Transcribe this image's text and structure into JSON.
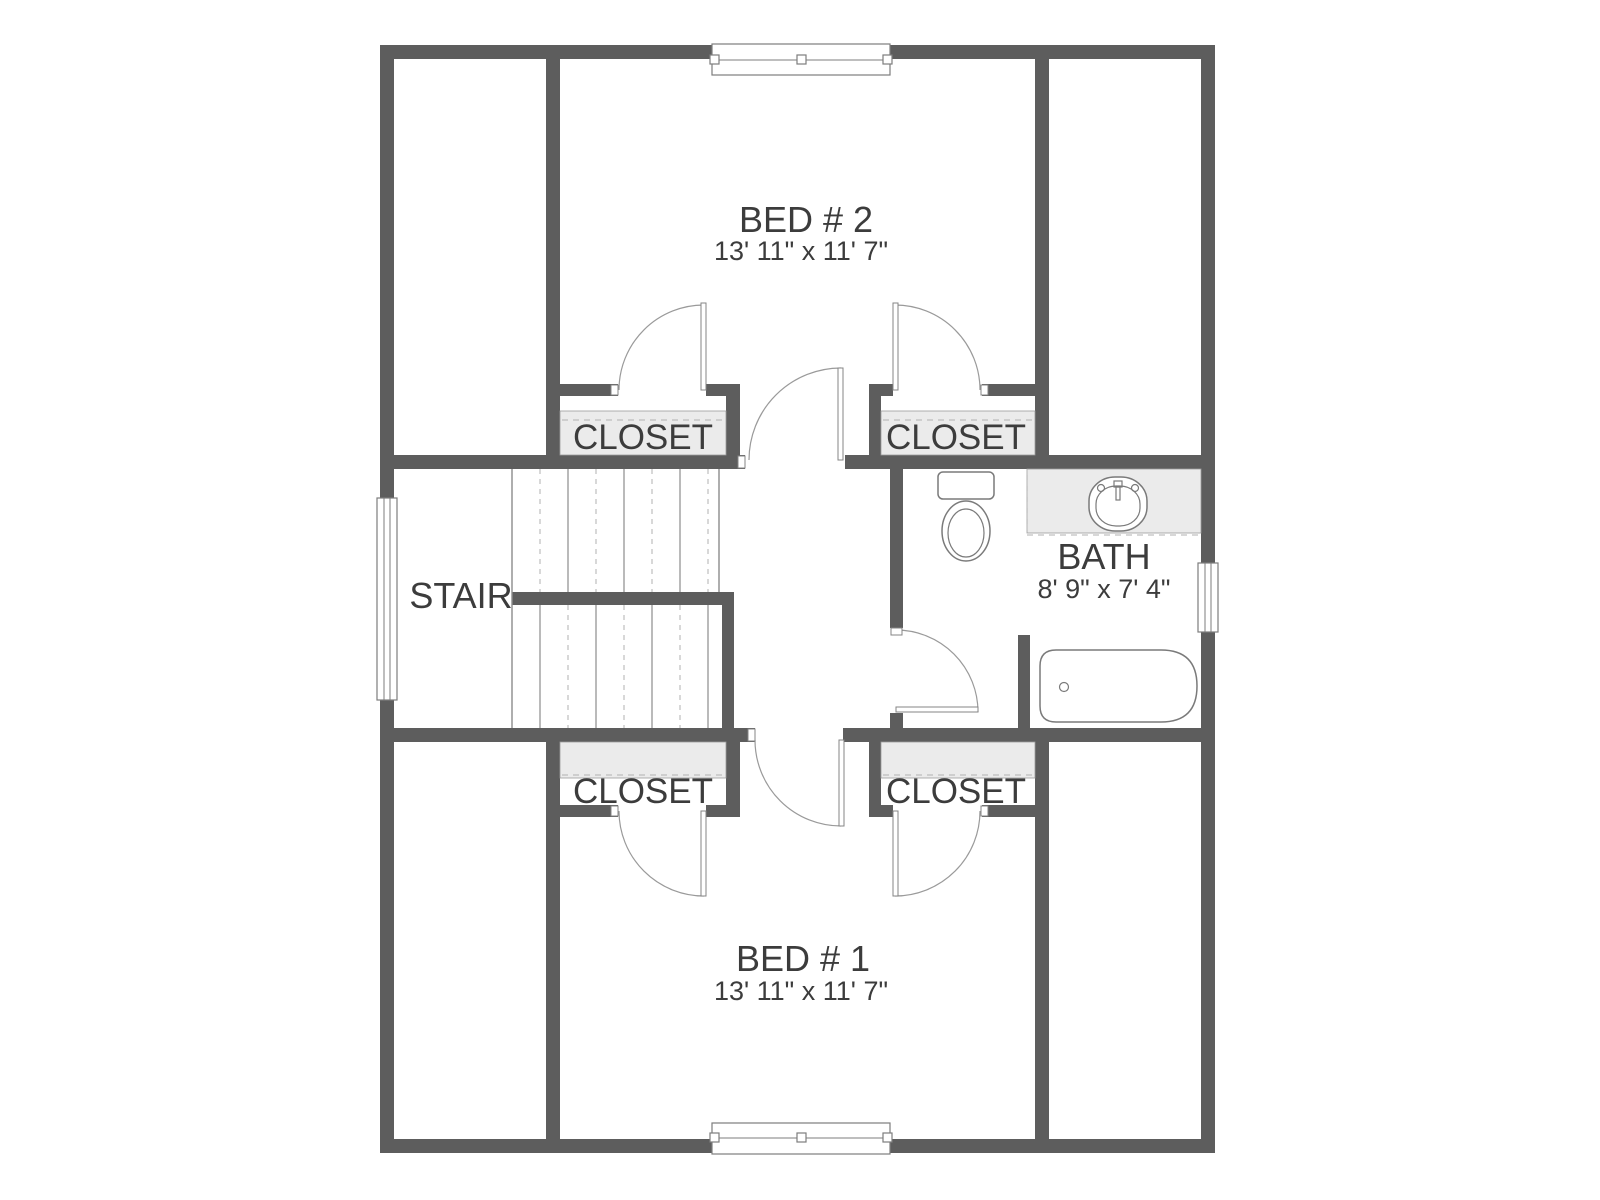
{
  "colors": {
    "wall": "#5d5d5d",
    "shelf": "#ebebeb",
    "arc": "#9a9a9a",
    "ink": "#3c3c3c",
    "fixture": "#7a7a7a"
  },
  "rooms": {
    "bed2": {
      "label": "BED # 2",
      "dims": "13' 11\" x 11' 7\""
    },
    "bed1": {
      "label": "BED # 1",
      "dims": "13' 11\" x 11' 7\""
    },
    "bath": {
      "label": "BATH",
      "dims": "8' 9\" x 7' 4\""
    },
    "stair": {
      "label": "STAIR"
    },
    "closet": {
      "label": "CLOSET"
    }
  }
}
